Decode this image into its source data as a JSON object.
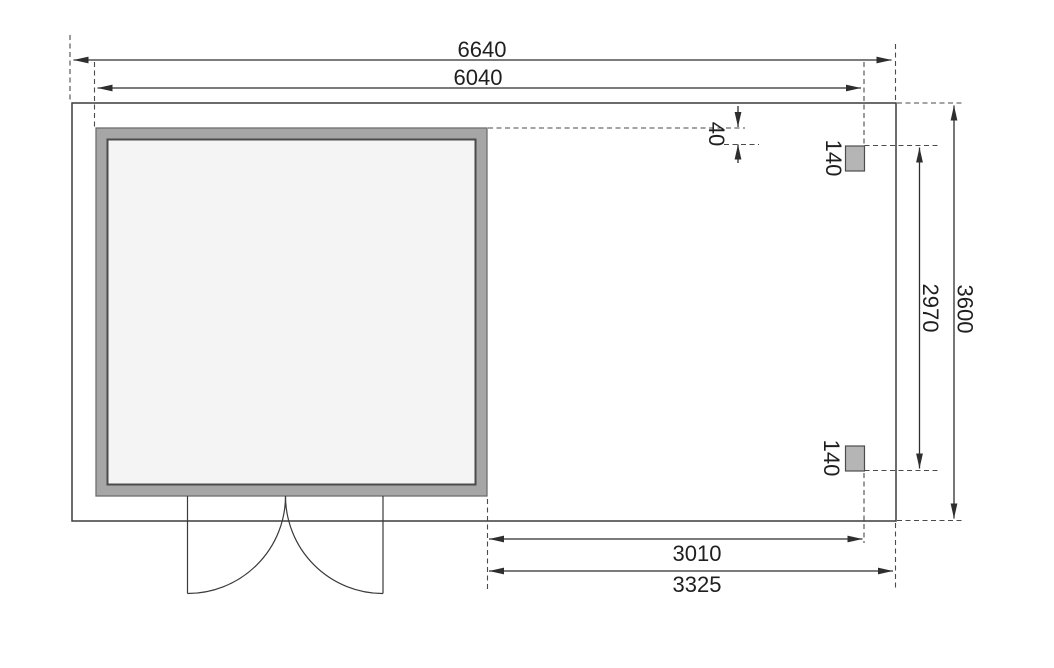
{
  "diagram": {
    "kind": "garden-house floor plan with side roof, dimensioned",
    "units_note": "mm",
    "colors": {
      "wall_band": "#a6a6a6",
      "interior": "#f4f4f4",
      "post": "#b5b5b5",
      "line": "#2e2e2e"
    },
    "labels": {
      "overall_width": "6640",
      "house_width": "6040",
      "roof_offset": "40",
      "post_top": "140",
      "post_bottom": "140",
      "post_span_depth": "2970",
      "overall_depth": "3600",
      "side_width_inner": "3010",
      "side_width_outer": "3325"
    }
  }
}
